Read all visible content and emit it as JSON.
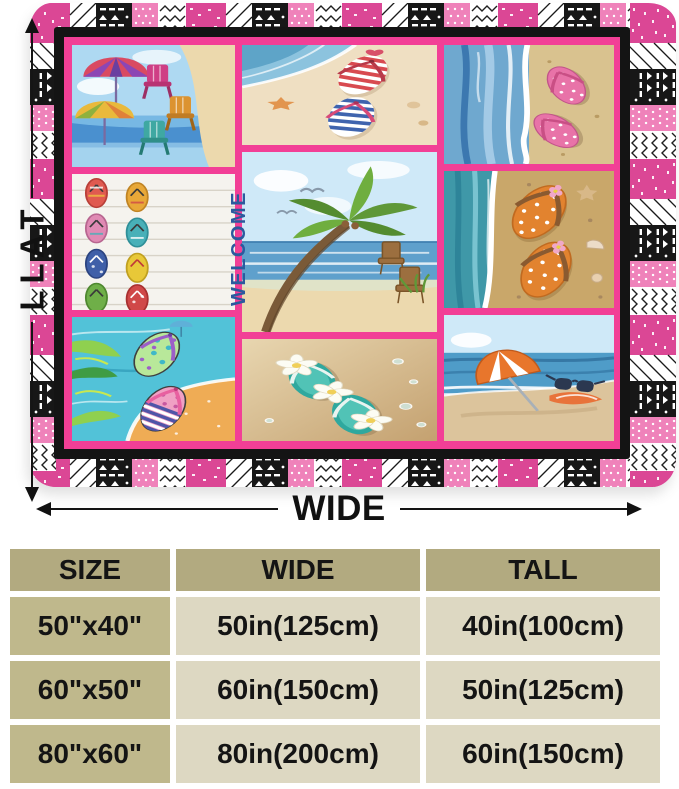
{
  "product_diagram": {
    "tall_arrow_label": "TALL",
    "wide_arrow_label": "WIDE"
  },
  "blanket": {
    "welcome_sign_text": "WELCOME",
    "style": {
      "border_pink": "#db4795",
      "light_pink": "#ef82ba",
      "frame_black": "#141414",
      "sash_pink": "#f23f96",
      "welcome_blue": "#2b5a9e"
    },
    "panels": [
      "beach-umbrellas-adirondack-chairs",
      "striped-flip-flops-on-shore",
      "pink-polka-dot-flip-flops-surf",
      "flip-flop-collection-welcome-sign",
      "palm-tree-beach-chairs",
      "orange-polka-dot-flip-flops-sand",
      "painted-flip-flops-palm-leaves",
      "teal-flip-flops-plumeria-flowers",
      "beach-umbrella-sunglasses-shore"
    ]
  },
  "size_table": {
    "headers": [
      "SIZE",
      "WIDE",
      "TALL"
    ],
    "rows": [
      {
        "size": "50\"x40\"",
        "wide": "50in(125cm)",
        "tall": "40in(100cm)"
      },
      {
        "size": "60\"x50\"",
        "wide": "60in(150cm)",
        "tall": "50in(125cm)"
      },
      {
        "size": "80\"x60\"",
        "wide": "80in(200cm)",
        "tall": "60in(150cm)"
      }
    ]
  }
}
